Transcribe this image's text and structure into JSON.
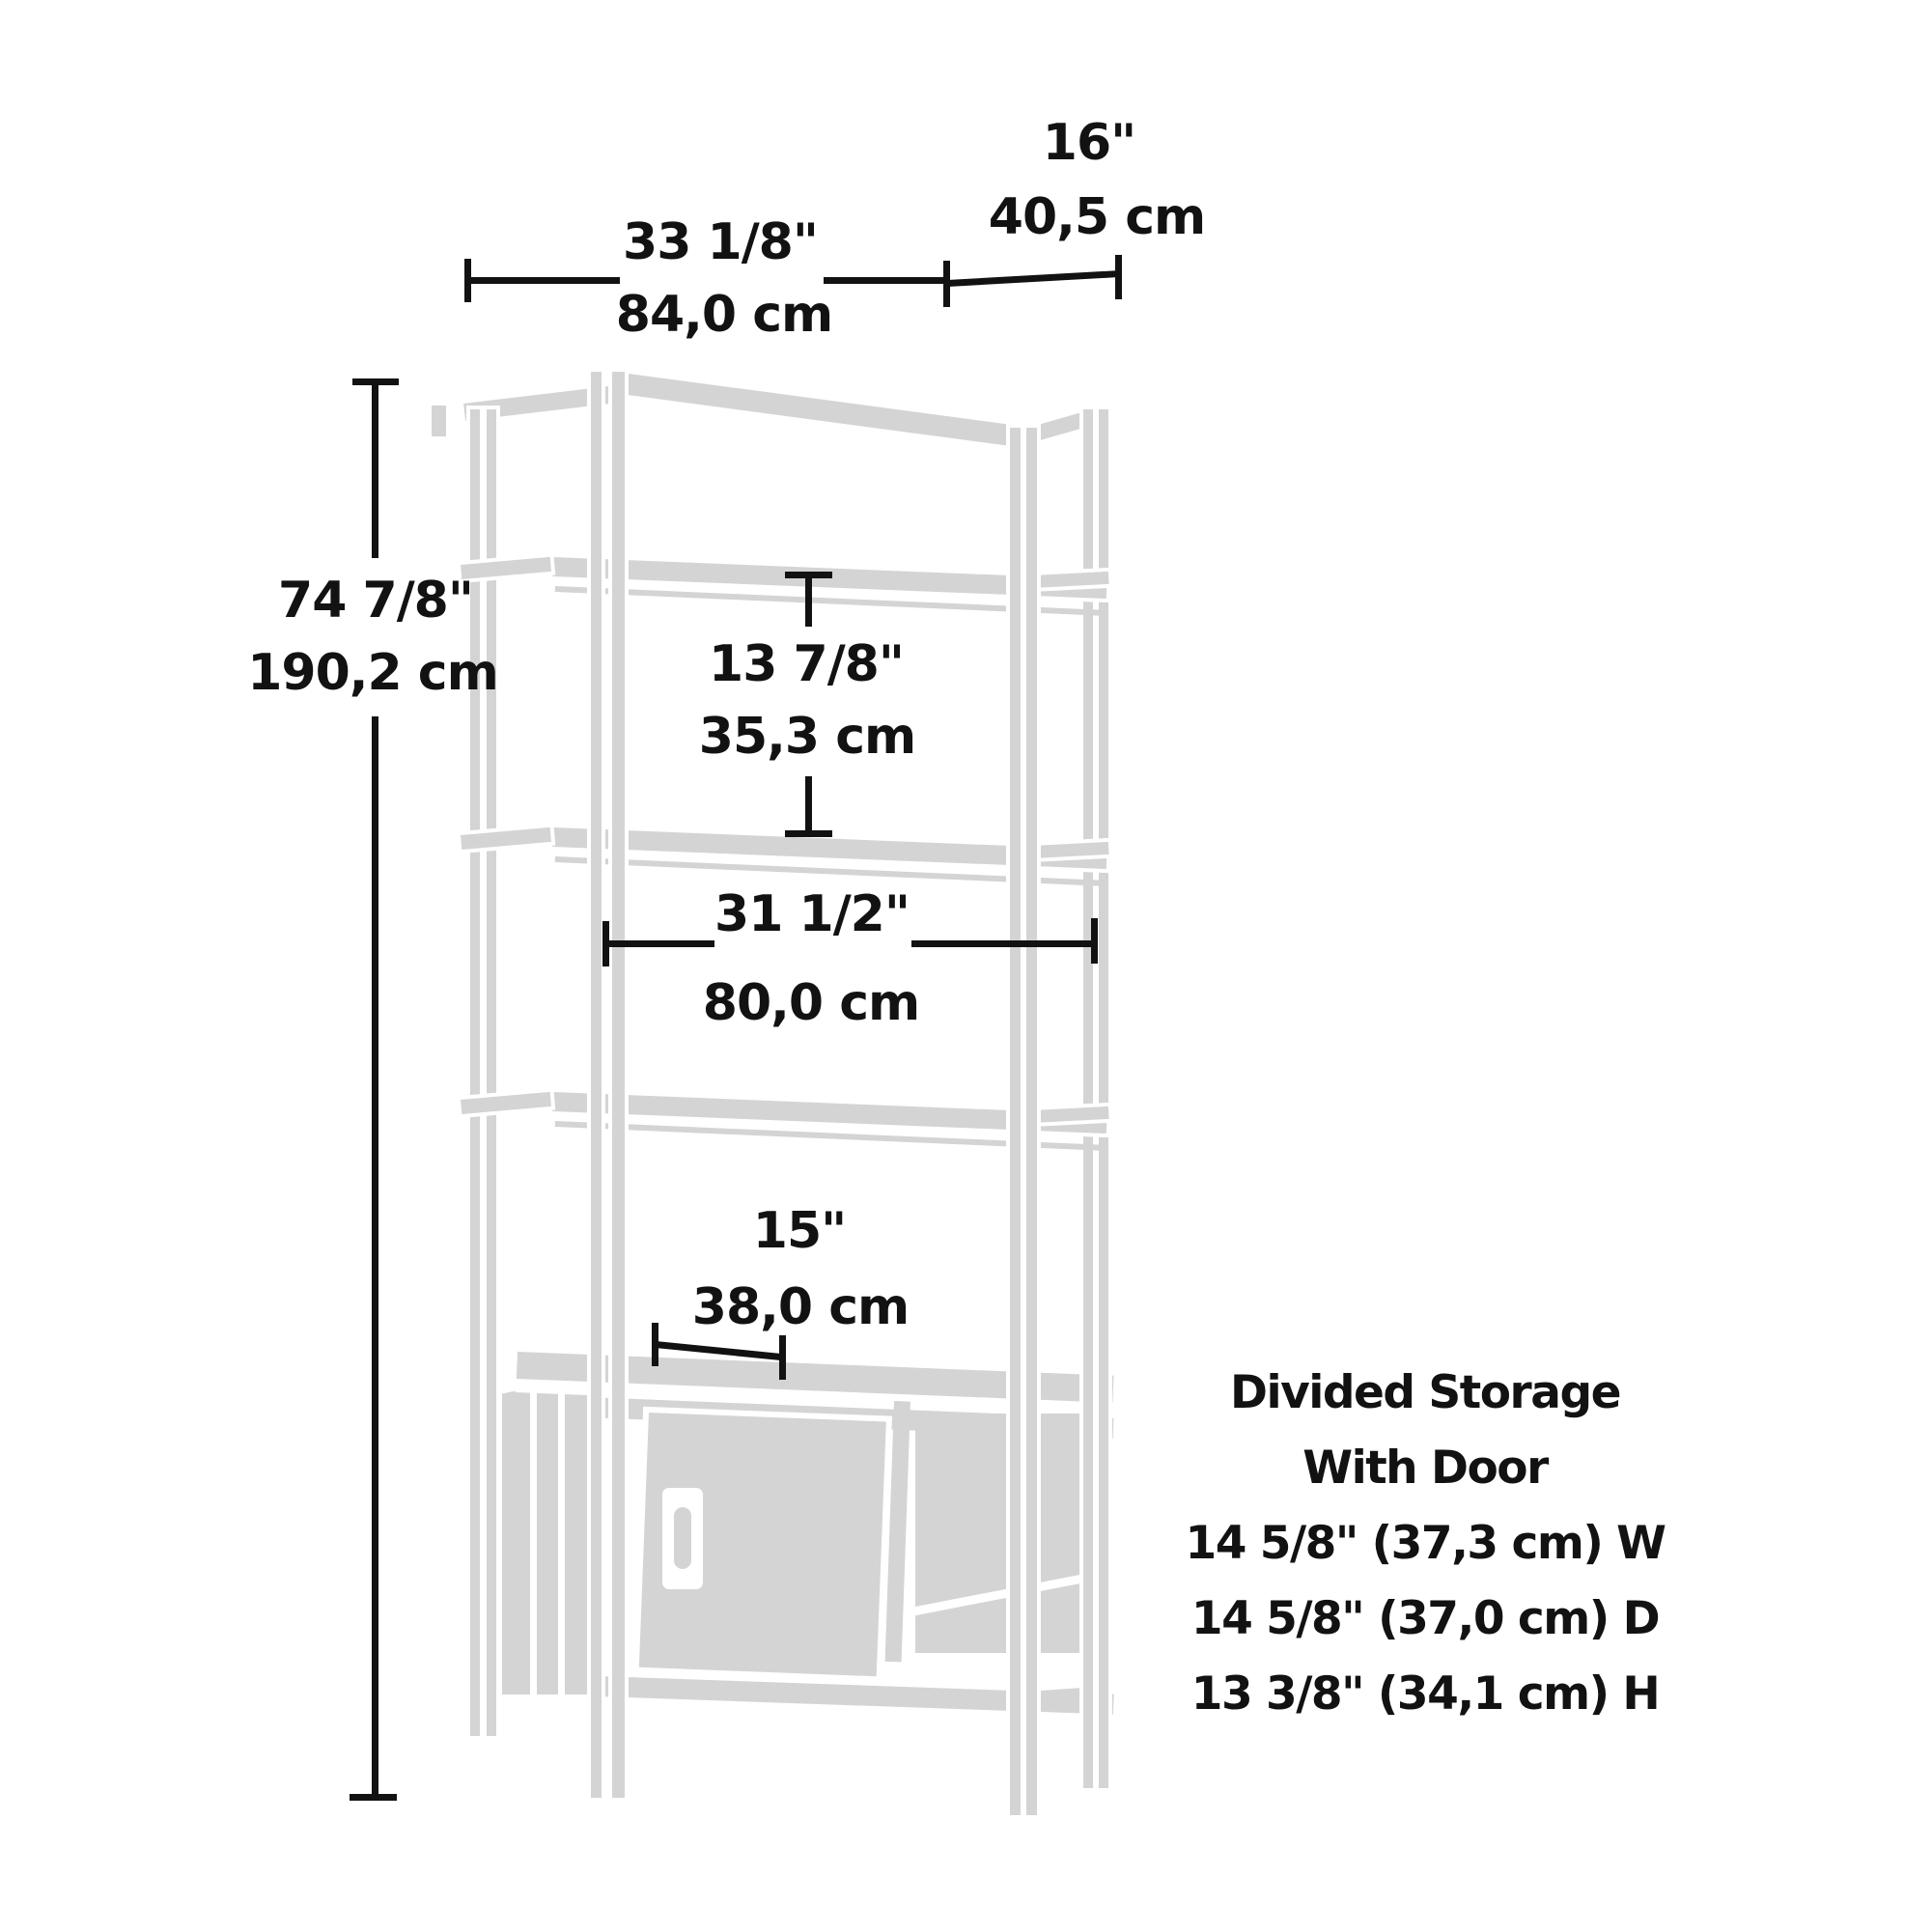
{
  "diagram_title": "Bookshelf with divided storage - dimension diagram",
  "colors": {
    "ink": "#121212",
    "drawing": "#d4d4d4",
    "background": "#ffffff"
  },
  "dims": {
    "width": {
      "in": "33 1/8\"",
      "cm": "84,0 cm"
    },
    "depth": {
      "in": "16\"",
      "cm": "40,5 cm"
    },
    "height": {
      "in": "74 7/8\"",
      "cm": "190,2 cm"
    },
    "shelf_gap": {
      "in": "13 7/8\"",
      "cm": "35,3 cm"
    },
    "inner_width": {
      "in": "31 1/2\"",
      "cm": "80,0 cm"
    },
    "storage_width": {
      "in": "15\"",
      "cm": "38,0 cm"
    }
  },
  "storage_note": {
    "line1": "Divided Storage",
    "line2": "With Door",
    "spec_w": "14 5/8\" (37,3 cm) W",
    "spec_d": "14 5/8\" (37,0 cm) D",
    "spec_h": "13 3/8\" (34,1 cm) H"
  }
}
